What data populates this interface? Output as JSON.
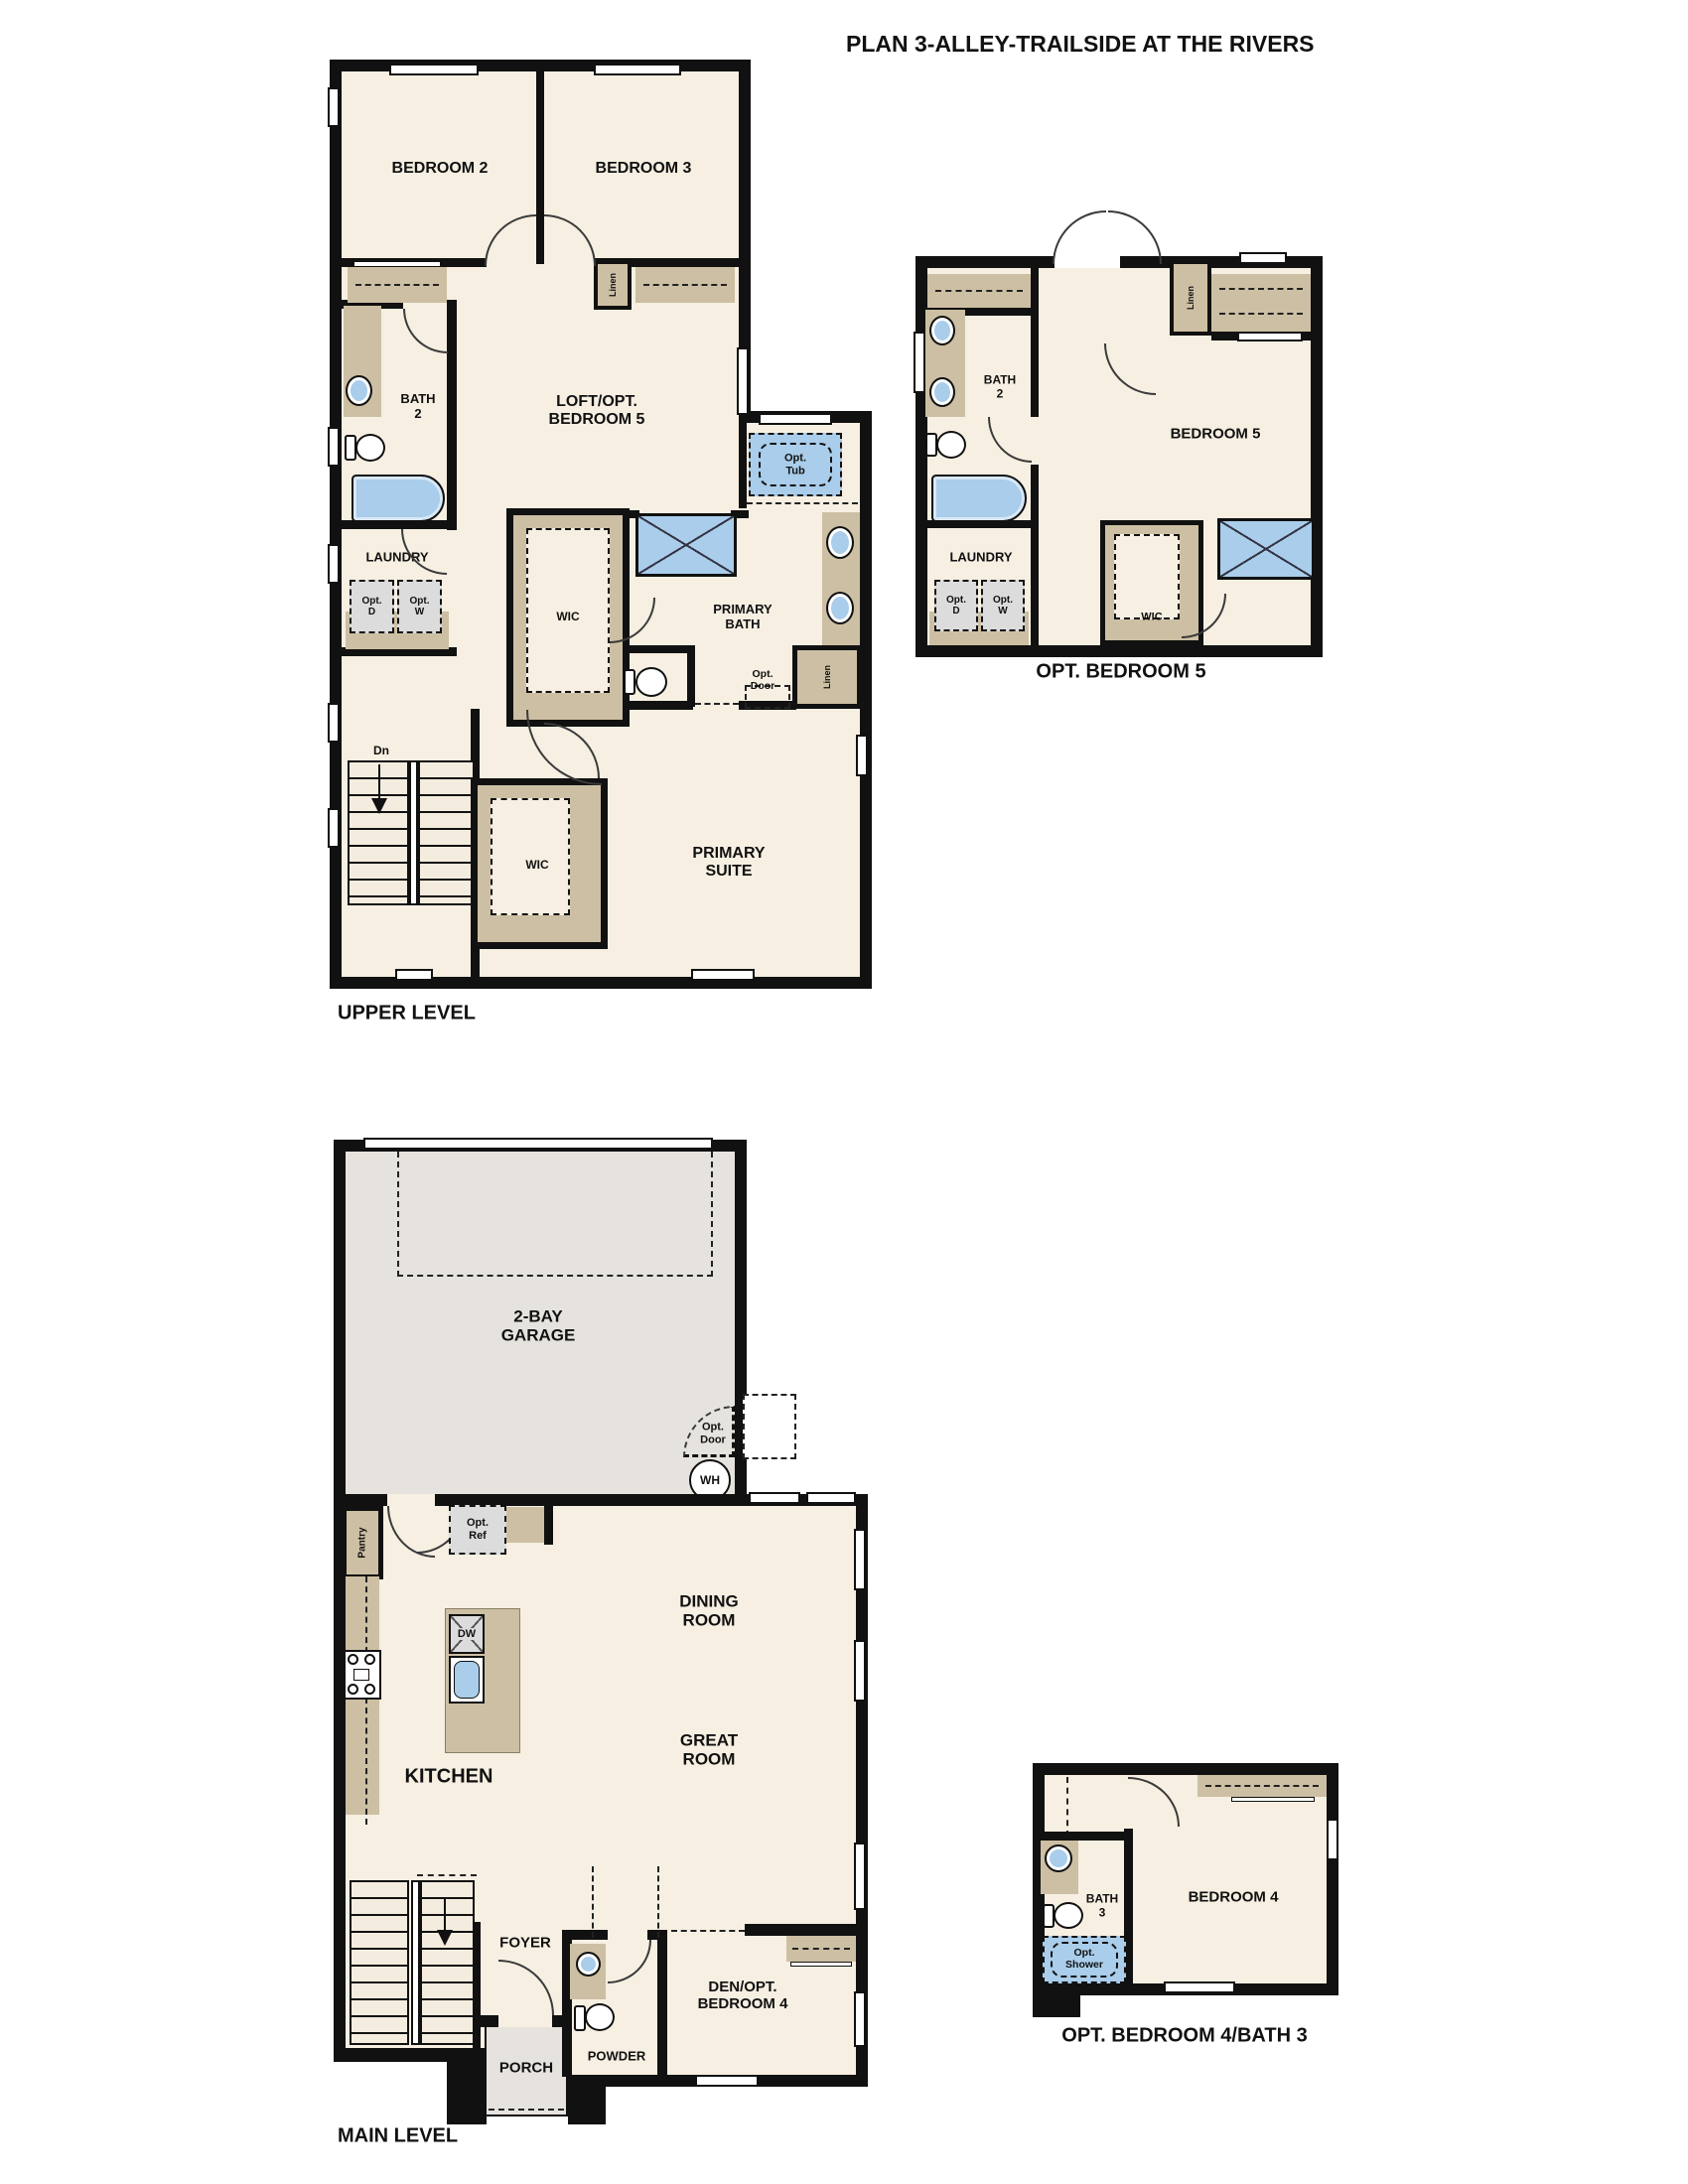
{
  "title": "PLAN 3-ALLEY-TRAILSIDE AT THE RIVERS",
  "colors": {
    "wall": "#111111",
    "floor": "#f6efe2",
    "closet_tan": "#cdbfa3",
    "garage_gray": "#e6e3de",
    "fixture_blue": "#a9cdea",
    "appliance_gray": "#dcdcdc"
  },
  "upper_level": {
    "label": "UPPER LEVEL",
    "bedroom2": "BEDROOM 2",
    "bedroom3": "BEDROOM 3",
    "hall_linen": "Linen",
    "bath2_l1": "BATH",
    "bath2_l2": "2",
    "loft_l1": "LOFT/OPT.",
    "loft_l2": "BEDROOM 5",
    "opt_tub_l1": "Opt.",
    "opt_tub_l2": "Tub",
    "laundry": "LAUNDRY",
    "opt_dryer_l1": "Opt.",
    "opt_dryer_l2": "D",
    "opt_washer_l1": "Opt.",
    "opt_washer_l2": "W",
    "wic_bath": "WIC",
    "primary_bath_l1": "PRIMARY",
    "primary_bath_l2": "BATH",
    "opt_door_l1": "Opt.",
    "opt_door_l2": "Door",
    "bath_linen": "Linen",
    "stairs_dn": "Dn",
    "wic_suite": "WIC",
    "primary_suite_l1": "PRIMARY",
    "primary_suite_l2": "SUITE"
  },
  "opt_bedroom5": {
    "label": "OPT. BEDROOM 5",
    "bath2_l1": "BATH",
    "bath2_l2": "2",
    "linen": "Linen",
    "bedroom5": "BEDROOM 5",
    "laundry": "LAUNDRY",
    "opt_dryer_l1": "Opt.",
    "opt_dryer_l2": "D",
    "opt_washer_l1": "Opt.",
    "opt_washer_l2": "W",
    "wic": "WIC"
  },
  "main_level": {
    "label": "MAIN LEVEL",
    "garage_l1": "2-BAY",
    "garage_l2": "GARAGE",
    "opt_door_l1": "Opt.",
    "opt_door_l2": "Door",
    "water_heater": "WH",
    "opt_ref_l1": "Opt.",
    "opt_ref_l2": "Ref",
    "pantry": "Pantry",
    "dishwasher": "DW",
    "kitchen": "KITCHEN",
    "dining_l1": "DINING",
    "dining_l2": "ROOM",
    "great_l1": "GREAT",
    "great_l2": "ROOM",
    "stairs_up": "Up",
    "foyer": "FOYER",
    "porch": "PORCH",
    "powder": "POWDER",
    "den_l1": "DEN/OPT.",
    "den_l2": "BEDROOM 4"
  },
  "opt_bedroom4": {
    "label": "OPT. BEDROOM 4/BATH 3",
    "bath3_l1": "BATH",
    "bath3_l2": "3",
    "opt_shower_l1": "Opt.",
    "opt_shower_l2": "Shower",
    "bedroom4": "BEDROOM 4"
  }
}
